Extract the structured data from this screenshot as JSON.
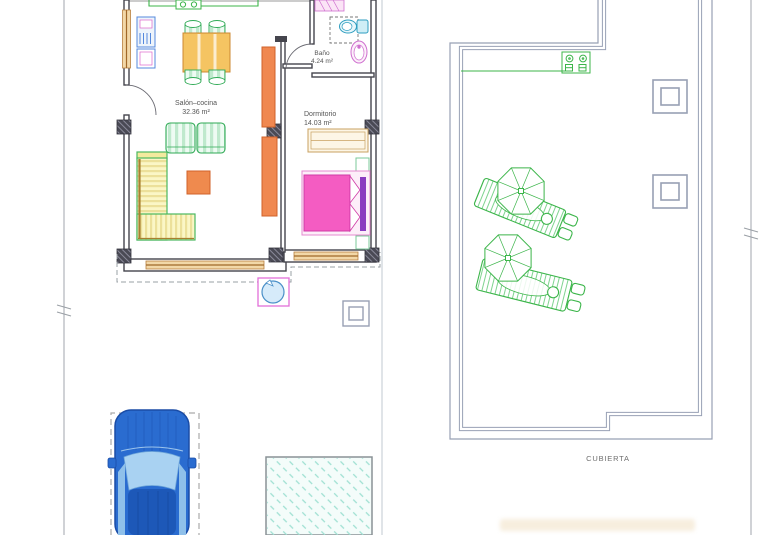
{
  "plan": {
    "rooms": [
      {
        "name": "Salón–cocina",
        "area": "32.36 m²"
      },
      {
        "name": "Dormitorio",
        "area": "14.03 m²"
      },
      {
        "name": "Baño",
        "area": "4.24 m²"
      }
    ],
    "roof_label": "CUBIERTA"
  },
  "symbols": [
    "car-top-view",
    "swimming-pool",
    "sun-lounger-with-parasol",
    "parasol-umbrella",
    "barbecue-grill",
    "skylight-square",
    "door-swing-arc",
    "window-symbol",
    "column-pillar",
    "toilet",
    "washbasin",
    "shower",
    "bed-double",
    "sofa-l-shape",
    "armchair",
    "dining-table",
    "fridge",
    "cooktop",
    "well-circle"
  ],
  "colors": {
    "furniture_green": "#3cb54a",
    "furniture_orange": "#f08850",
    "table_yellow": "#f5c462",
    "sofa_yellow": "#faf4b4",
    "bed_pink": "#f45cc2",
    "bed_purple": "#8a3cc0",
    "bath_pink": "#cf6fcf",
    "window_tan": "#f2d8a8",
    "wall_gray": "#45454d",
    "roof_outline": "#98a0b4",
    "pool_fill": "#f4fcfa",
    "pool_hatch": "#9fe0d2",
    "car_blue": "#2a6cd0",
    "dashed_gray": "#9aa0a6"
  }
}
